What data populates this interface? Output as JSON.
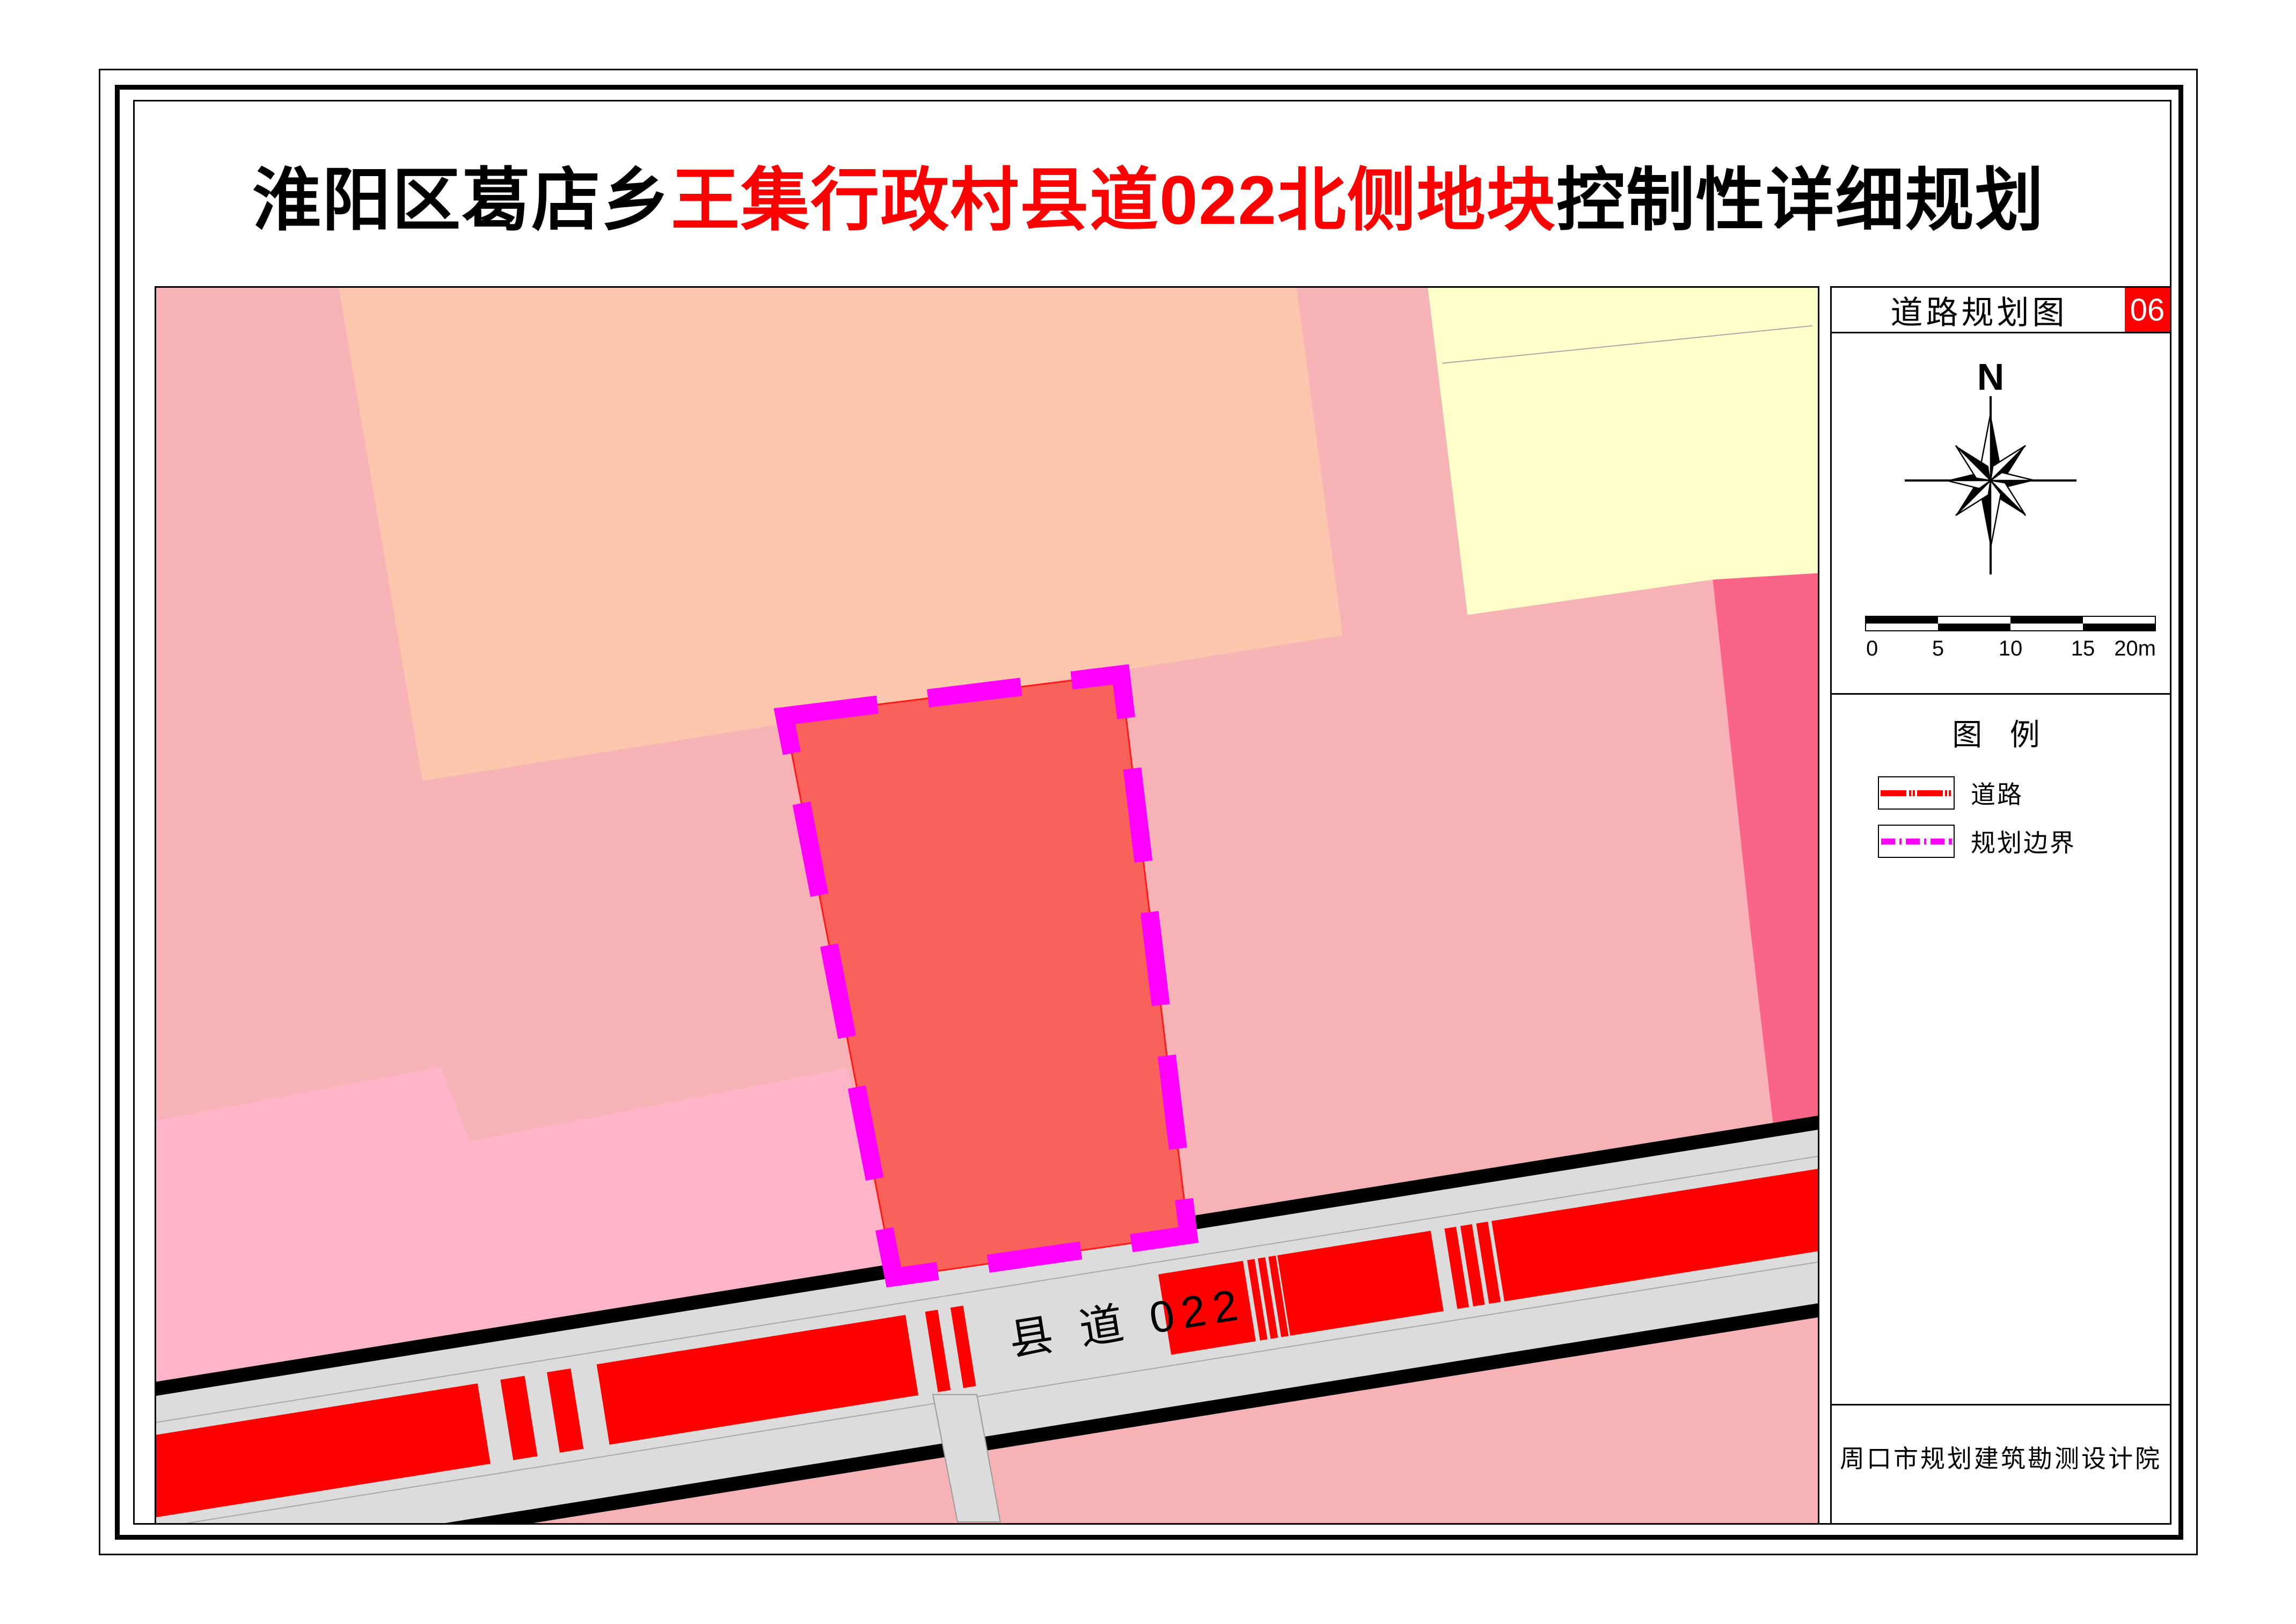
{
  "title": {
    "black1": "淮阳区葛店乡",
    "red": "王集行政村县道022北侧地块",
    "black2": "控制性详细规划"
  },
  "map": {
    "road_label": "县 道 022"
  },
  "sidebar": {
    "header": {
      "title": "道路规划图",
      "number": "06"
    },
    "compass": {
      "north_label": "N"
    },
    "scalebar": {
      "labels": [
        "0",
        "5",
        "10",
        "15",
        "20m"
      ]
    },
    "legend": {
      "title": "图 例",
      "items": [
        {
          "label": "道路",
          "symbol": "red-road-line"
        },
        {
          "label": "规划边界",
          "symbol": "magenta-dashed-line"
        }
      ]
    },
    "footer": {
      "institute": "周口市规划建筑勘测设计院"
    }
  },
  "colors": {
    "pink_bg": "#F6B2B5",
    "salmon": "#FCC7AC",
    "pale_yellow": "#FFFFC9",
    "deep_pink": "#FA6488",
    "light_pink": "#FFB5C7",
    "plot_red": "#F8625B",
    "plot_outline": "#FF1A1A",
    "magenta": "#FF00FF",
    "road_gray": "#DCDCDC",
    "road_red": "#FF0000",
    "edge_black": "#000000",
    "parcel_line": "#A8A8A8",
    "header_red": "#FF0000"
  }
}
